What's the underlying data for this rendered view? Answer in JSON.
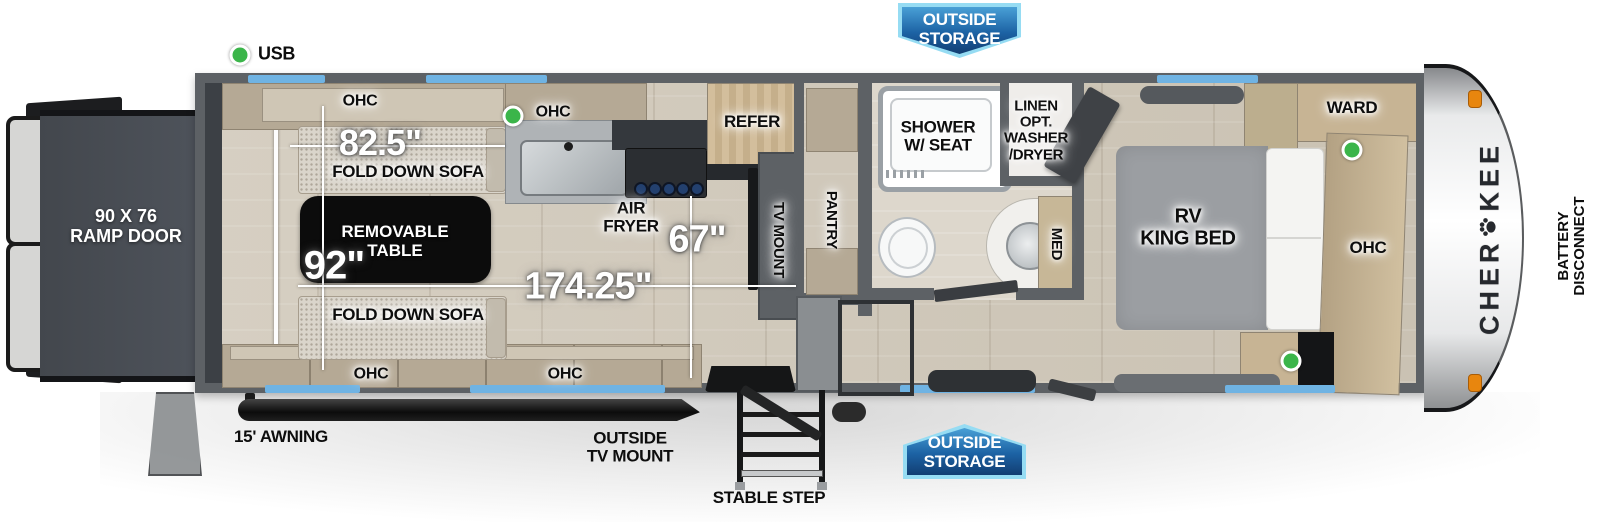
{
  "legend": {
    "usb": "USB"
  },
  "badges": {
    "top": {
      "line1": "OUTSIDE",
      "line2": "STORAGE"
    },
    "bottom": {
      "line1": "OUTSIDE",
      "line2": "STORAGE"
    }
  },
  "exterior": {
    "ramp_line1": "90 X 76",
    "ramp_line2": "RAMP DOOR",
    "awning": "15' AWNING",
    "tv_line1": "OUTSIDE",
    "tv_line2": "TV MOUNT",
    "step": "STABLE STEP",
    "battery_line1": "BATTERY",
    "battery_line2": "DISCONNECT",
    "brand_full": "CHEROKEE",
    "brand_prefix": "CHER",
    "brand_suffix": "KEE"
  },
  "dims": {
    "sofa": "82.5\"",
    "garage_width": "92\"",
    "cargo": "174.25\"",
    "aisle": "67\""
  },
  "garage": {
    "ohc_top": "OHC",
    "ohc_kitchen": "OHC",
    "ohc_bottom_rear": "OHC",
    "ohc_bottom_mid": "OHC",
    "sofa_top": "FOLD DOWN SOFA",
    "sofa_bottom": "FOLD DOWN SOFA",
    "table_line1": "REMOVABLE",
    "table_line2": "TABLE",
    "airfryer_line1": "AIR",
    "airfryer_line2": "FRYER"
  },
  "kitchen": {
    "refer": "REFER",
    "tv_mount": "TV MOUNT",
    "pantry": "PANTRY"
  },
  "bath": {
    "shower_line1": "SHOWER",
    "shower_line2": "W/ SEAT",
    "linen_line1": "LINEN",
    "linen_line2": "OPT.",
    "linen_line3": "WASHER",
    "linen_line4": "/DRYER",
    "med": "MED"
  },
  "bedroom": {
    "bed_line1": "RV",
    "bed_line2": "KING BED",
    "ward": "WARD",
    "ohc": "OHC"
  },
  "colors": {
    "window_blue": "#6fb3e3",
    "badge_border": "#96dcf3",
    "badge_gradient_top": "#3d97cf",
    "badge_gradient_bottom": "#123f74",
    "usb_green": "#3bb54a",
    "marker_orange": "#e8860e",
    "wall_gray": "#5d6165"
  }
}
